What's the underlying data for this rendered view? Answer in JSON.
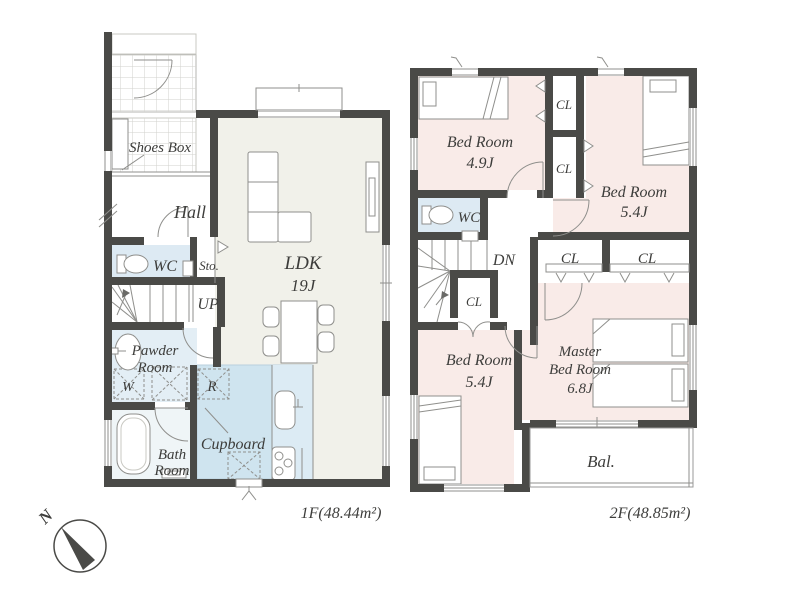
{
  "palette": {
    "wall": "#4a4a47",
    "line": "#8f8f8c",
    "line_light": "#c9c9c3",
    "text": "#3d3d3b",
    "ldk_floor": "#f1f1ea",
    "kitchen_floor": "#cfe4ef",
    "kitchen_counter": "#dcebf4",
    "wet_area": "#e3eef5",
    "wc_floor": "#ddeaf3",
    "bath_floor": "#eff5f7",
    "bedroom_floor": "#f9ebe8"
  },
  "floor1": {
    "area_label": "1F(48.44m²)",
    "labels": {
      "shoes_box": "Shoes Box",
      "hall": "Hall",
      "wc": "WC",
      "storage": "Sto.",
      "stairs": "UP",
      "powder_line1": "Pawder",
      "powder_line2": "Room",
      "washer": "W",
      "refrigerator": "R",
      "cupboard": "Cupboard",
      "bath_line1": "Bath",
      "bath_line2": "Room",
      "ldk_line1": "LDK",
      "ldk_line2": "19J"
    }
  },
  "floor2": {
    "area_label": "2F(48.85m²)",
    "labels": {
      "bedroom1_line1": "Bed Room",
      "bedroom1_line2": "4.9J",
      "closet1": "CL",
      "closet2": "CL",
      "bedroom2_line1": "Bed Room",
      "bedroom2_line2": "5.4J",
      "wc": "WC",
      "stairs": "DN",
      "closet3": "CL",
      "closet4": "CL",
      "closet5": "CL",
      "bedroom3_line1": "Bed Room",
      "bedroom3_line2": "5.4J",
      "master_line1": "Master",
      "master_line2": "Bed Room",
      "master_line3": "6.8J",
      "balcony": "Bal."
    }
  },
  "compass": {
    "north": "N"
  }
}
